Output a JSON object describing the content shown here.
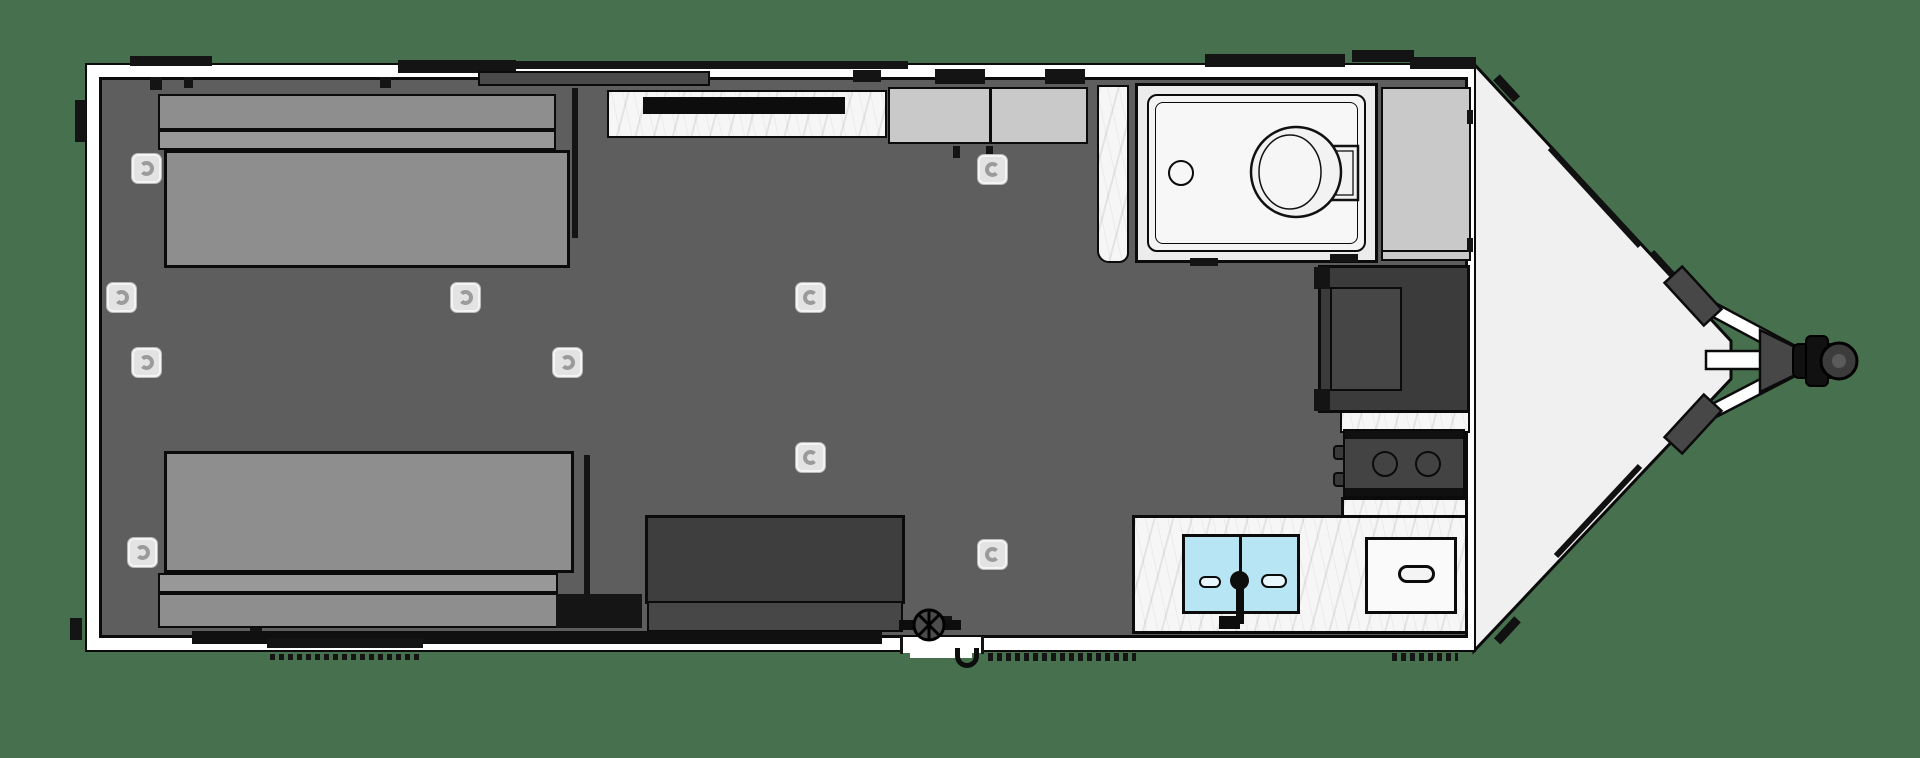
{
  "scene": {
    "description": "Top-down CAD-style floor plan of a V-nose travel trailer (toy hauler) with rear sofa-beds, center kitchen, wet bath, galley and hitch tongue",
    "view": "top-down plan",
    "visible_text": []
  },
  "colors": {
    "background": "#47704e",
    "outline": "#0b0b0b",
    "wall": "#ffffff",
    "floor": "#5e5e5e",
    "bed": "#8e8e8e",
    "bed_band": "#989898",
    "dark_furniture": "#3e3e3e",
    "dark_band": "#474747",
    "cabinet": "#c9c9c9",
    "bath_floor": "#ececec",
    "shower_pan": "#f4f4f4",
    "marble": "#f6f6f6",
    "sink": "#b7e5f4",
    "sink_drain": "#e8f7fd",
    "handle_bg": "#e3e3e3",
    "handle_ring": "#9b9b9b",
    "nose": "#f0f0f0",
    "plate": "#474747",
    "appliance": "#434343",
    "window_dark": "#4a4a4a",
    "black_trim": "#141414"
  },
  "fixtures": [
    {
      "name": "sofa-bed-top"
    },
    {
      "name": "sofa-bed-bottom"
    },
    {
      "name": "kitchen-counter"
    },
    {
      "name": "overhead-cabinet"
    },
    {
      "name": "wet-bath-shower"
    },
    {
      "name": "toilet"
    },
    {
      "name": "wardrobe-cabinet"
    },
    {
      "name": "refrigerator"
    },
    {
      "name": "cooktop"
    },
    {
      "name": "galley-counter"
    },
    {
      "name": "double-sink"
    },
    {
      "name": "faucet"
    },
    {
      "name": "drawer-cabinet"
    },
    {
      "name": "bench-table"
    },
    {
      "name": "entry-door"
    },
    {
      "name": "v-nose-front"
    },
    {
      "name": "hitch-a-frame"
    },
    {
      "name": "hitch-coupler"
    },
    {
      "name": "floor-tie-down-rings"
    },
    {
      "name": "vent-symbol"
    }
  ],
  "tie_down_rings": [
    {
      "x": 131,
      "y": 153,
      "gap": "left"
    },
    {
      "x": 106,
      "y": 282,
      "gap": "left"
    },
    {
      "x": 131,
      "y": 347,
      "gap": "left"
    },
    {
      "x": 552,
      "y": 347,
      "gap": "left"
    },
    {
      "x": 127,
      "y": 537,
      "gap": "left"
    },
    {
      "x": 450,
      "y": 282,
      "gap": "left"
    },
    {
      "x": 795,
      "y": 282,
      "gap": "right"
    },
    {
      "x": 795,
      "y": 442,
      "gap": "right"
    },
    {
      "x": 977,
      "y": 154,
      "gap": "right"
    },
    {
      "x": 977,
      "y": 539,
      "gap": "right"
    }
  ],
  "counts": {
    "tie_down_rings": 10,
    "cooktop_burners": 2,
    "sink_basins": 2,
    "beds": 2,
    "overhead_cabinet_doors": 2
  }
}
